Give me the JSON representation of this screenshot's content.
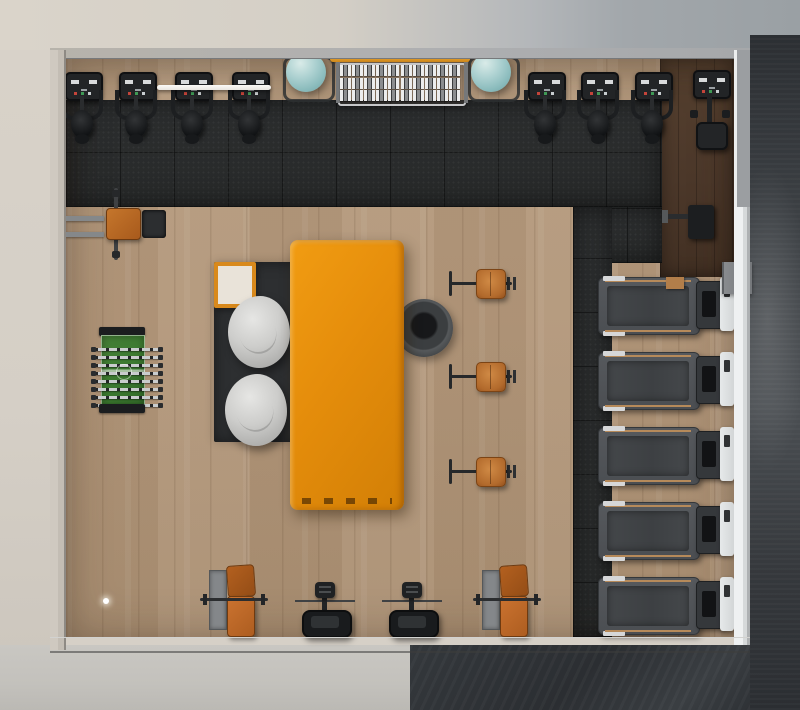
{
  "scene": {
    "type": "3d-render-top-down",
    "title": "Gym and games room interior, top-down architectural render",
    "palette": {
      "outer_top": "#d7d1c8",
      "outer_left": "#d6d0c7",
      "outer_bottom_left": "#c8c6c1",
      "outer_dark_concrete": "#34373b",
      "wall_beam": "#aeafb1",
      "right_wall_white": "#eff1f2",
      "wood_floor": "#b2977b",
      "walnut_floor": "#4c382a",
      "rubber_mat": "#2a2c2d",
      "accent_orange": "#d8891c",
      "lounge_table_orange": "#e58d0b",
      "teal_ball": "#9ec7c7",
      "bean_bag_gray": "#cbcbc9",
      "rug_dark": "#2d2f31",
      "leather_tan": "#b26a2c",
      "foosball_green": "#3c7a30",
      "chrome": "#c6c7c9",
      "treadmill_gray": "#53565a"
    },
    "equipment": {
      "spin_bikes": [
        {
          "left": 60,
          "top": 64
        },
        {
          "left": 114,
          "top": 64
        },
        {
          "left": 170,
          "top": 64
        },
        {
          "left": 227,
          "top": 64
        },
        {
          "left": 523,
          "top": 64
        },
        {
          "left": 576,
          "top": 64
        },
        {
          "left": 630,
          "top": 64
        }
      ],
      "upright_bike": {
        "left": 688,
        "top": 62
      },
      "exercise_balls": [
        {
          "left": 283,
          "top": 52
        },
        {
          "left": 468,
          "top": 52
        }
      ],
      "white_barbell": {
        "left": 157,
        "top": 85,
        "width": 114
      },
      "dumbbell_rack": {
        "left": 338,
        "top": 55,
        "rows": 3,
        "cols": 10,
        "cell_count": 30
      },
      "bench_press_station": {
        "left": 66,
        "top": 188
      },
      "foosball_table": {
        "left": 97,
        "top": 327,
        "rod_count": 8
      },
      "bean_bags": [
        {
          "left": 228,
          "top": 296
        },
        {
          "left": 225,
          "top": 374
        }
      ],
      "side_table": {
        "left": 214,
        "top": 262
      },
      "lounge_table": {
        "left": 290,
        "top": 240
      },
      "round_pouf": {
        "left": 395,
        "top": 299
      },
      "barbell_stations": [
        {
          "left": 450,
          "top": 269
        },
        {
          "left": 450,
          "top": 362
        },
        {
          "left": 450,
          "top": 457
        }
      ],
      "treadmills": [
        {
          "left": 598,
          "top": 275
        },
        {
          "left": 598,
          "top": 350
        },
        {
          "left": 598,
          "top": 425
        },
        {
          "left": 598,
          "top": 500
        },
        {
          "left": 598,
          "top": 575
        }
      ],
      "floor_benches": [
        {
          "left": 205,
          "top": 558
        },
        {
          "left": 478,
          "top": 558
        }
      ],
      "ab_machines": [
        {
          "left": 295,
          "top": 578
        },
        {
          "left": 382,
          "top": 578
        }
      ],
      "wall_monitor": {
        "left": 688,
        "top": 205
      },
      "utility_block": {
        "left": 722,
        "top": 262
      },
      "wood_step": {
        "left": 666,
        "top": 277
      },
      "floor_marker_light": {
        "left": 103,
        "top": 598
      }
    }
  }
}
